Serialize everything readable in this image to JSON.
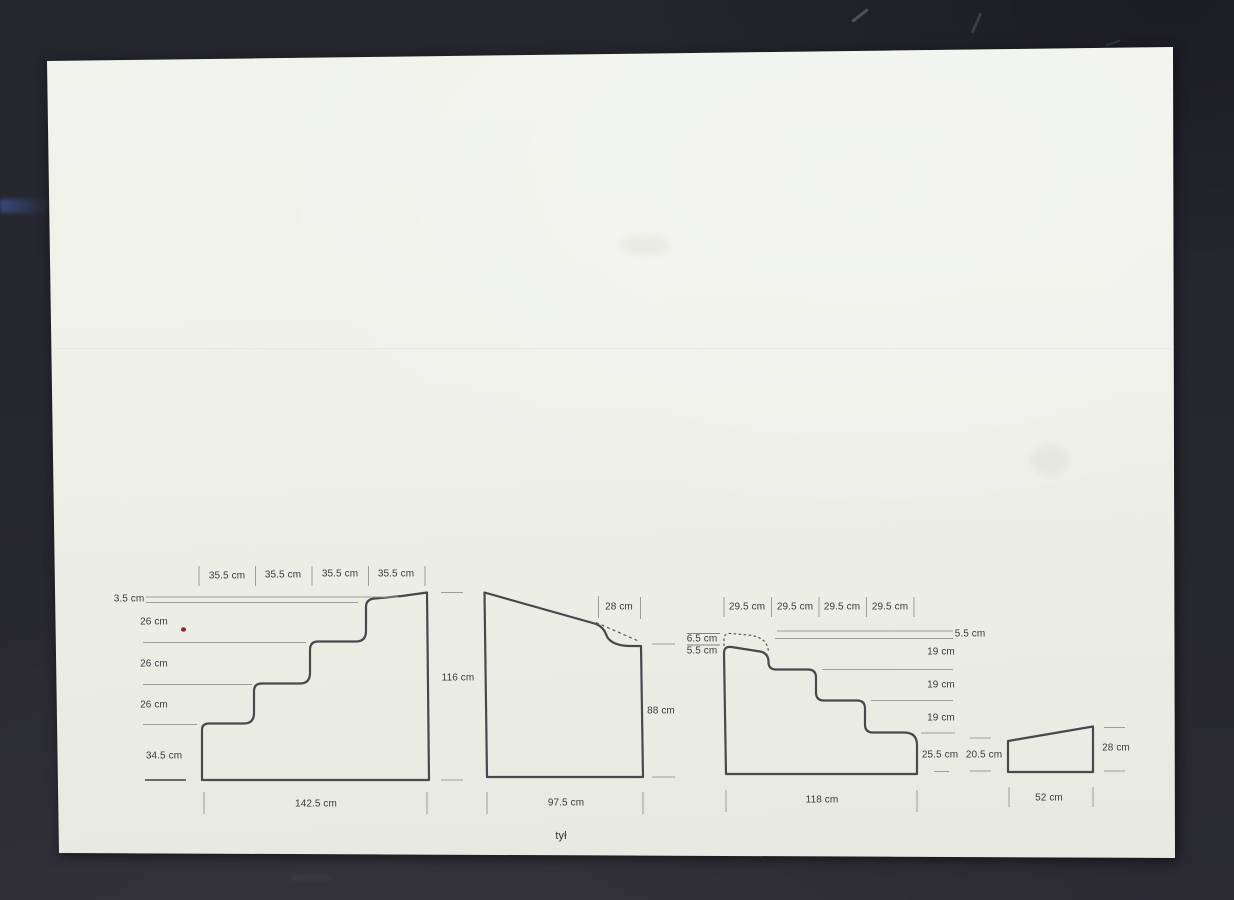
{
  "document": {
    "type": "scanned dimensioned drawing",
    "footer_label": "tył"
  },
  "colors": {
    "background": "#262630",
    "paper": "#eff1e9",
    "outline": "#48484d",
    "dim_line": "#9e9e97",
    "text": "#3a3a3e",
    "red_dot": "#8c2b24",
    "blue_streak": "#405ca5"
  },
  "panels": {
    "staircase_large": {
      "description": "large staircase profile, steps ascending to the right",
      "top_dims": [
        "35.5 cm",
        "35.5 cm",
        "35.5 cm",
        "35.5 cm"
      ],
      "left_dims": [
        "3.5 cm",
        "26 cm",
        "26 cm",
        "26 cm",
        "34.5 cm"
      ],
      "right_dim": "116 cm",
      "bottom_dim": "142.5 cm"
    },
    "wedge_large": {
      "description": "large sloped panel with small notch at upper right",
      "top_dim": "28 cm",
      "right_dim": "88 cm",
      "bottom_dim": "97.5 cm"
    },
    "staircase_small": {
      "description": "staircase profile, steps descending to the right, dashed cut at top left",
      "top_dims": [
        "29.5 cm",
        "29.5 cm",
        "29.5 cm",
        "29.5 cm"
      ],
      "left_dims": [
        "6.5 cm",
        "5.5 cm"
      ],
      "right_dims": [
        "5.5 cm",
        "19 cm",
        "19 cm",
        "19 cm",
        "25.5 cm"
      ],
      "bottom_dim": "118 cm"
    },
    "wedge_small": {
      "description": "small wedge profile",
      "left_dim": "20.5 cm",
      "right_dim": "28 cm",
      "bottom_dim": "52 cm"
    }
  }
}
